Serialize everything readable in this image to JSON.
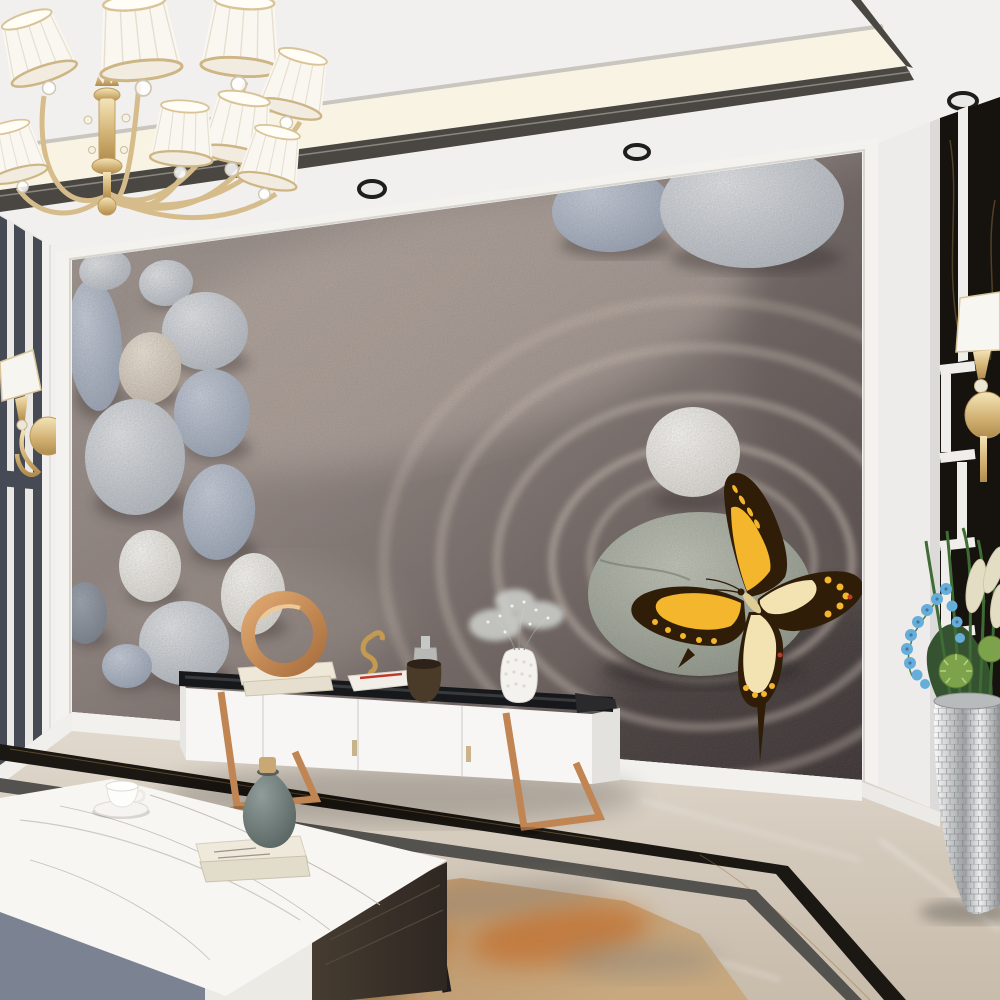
{
  "scene": {
    "setting": "modern living room interior",
    "focal_art": "zen pebble wall mural with a golden swallowtail butterfly",
    "lighting": "recessed ceiling spotlights with warm cove lighting",
    "no_visible_text": true
  },
  "colors": {
    "ceiling_white": "#f1f0ee",
    "cove_glow": "#f8f3e2",
    "ceiling_band": "#4a4742",
    "wall_white": "#eae8e5",
    "wall_stripe": "#454a55",
    "black_marble": "#16120e",
    "mural_frame": "#f3f2ef",
    "butterfly_yellow": "#f4b62c",
    "butterfly_dark": "#2f1d07",
    "butterfly_pale": "#f3e3b2",
    "gold": "#d6bc8a",
    "rose_gold": "#c08552",
    "console_white": "#f7f6f4",
    "console_top": "#16181b",
    "floor_border_black": "#1b1712",
    "floor_border_graphite": "#54524e",
    "rug_orange": "#c26a28",
    "table_gray": "#7b8392",
    "table_white": "#eceae5",
    "table_wood": "#3a322a",
    "leg_black": "#1c1c1f",
    "vase_teal": "#5d6a67",
    "plant_green": "#3f6b35",
    "orchid_blue": "#66aed9",
    "plume_cream": "#e3ddc4",
    "silver": "#c9cbcc",
    "shade_white": "#faf7f1",
    "spot_ring": "#1e1e1e"
  },
  "ceiling": {
    "style": "white tray ceiling with dark metal trim band and cove light",
    "spotlight_count": 4
  },
  "chandelier": {
    "material": "polished gold with crystal drops",
    "shade_count": 8,
    "shade_style": "white pleated drum shades"
  },
  "mural": {
    "background": "weathered warm-gray sand surface",
    "left_stone_count": 13,
    "top_right_stone_count": 2,
    "center_stones": [
      "small white pebble",
      "large gray-green pebble"
    ],
    "ripple_ring_count": 5,
    "butterfly": {
      "look": "swallowtail",
      "wing_colors": [
        "golden yellow",
        "dark brown"
      ],
      "accents": "red spots and pale hindwing centers"
    }
  },
  "walls": {
    "left": "white panel with dark vertical marble stripes and gold sconce",
    "right": "black marble panel with white geometric inlay and gold sconce",
    "sconce_count": 2
  },
  "furniture": {
    "tv_console": {
      "finish": "white lacquer",
      "top": "black glass",
      "legs": "rose gold",
      "door_count": 4,
      "decor": [
        "gold ring sculpture on cream books",
        "gold seahorse figurine",
        "white book with red pen",
        "glass bottle",
        "bronze vessel",
        "white sculpted vase with baby's breath",
        "dark book stack"
      ]
    },
    "coffee_table": {
      "top": "white marble",
      "drawer_fronts": [
        "gray-blue",
        "white"
      ],
      "side": "dark walnut",
      "legs": "black metal",
      "decor": [
        "white tea cup on saucer",
        "two stacked books",
        "teal vase with wooden stopper"
      ]
    },
    "planter": {
      "vase": "silver mirror mosaic",
      "plants": [
        "blue orchid cascade",
        "green spiky succulent balls",
        "cream plumes",
        "tall grass leaves"
      ]
    }
  },
  "floor": {
    "material": "polished beige marble",
    "inlay_borders": [
      "black-gold marble",
      "graphite"
    ],
    "rug": "abstract rust-orange, gray and cream"
  }
}
